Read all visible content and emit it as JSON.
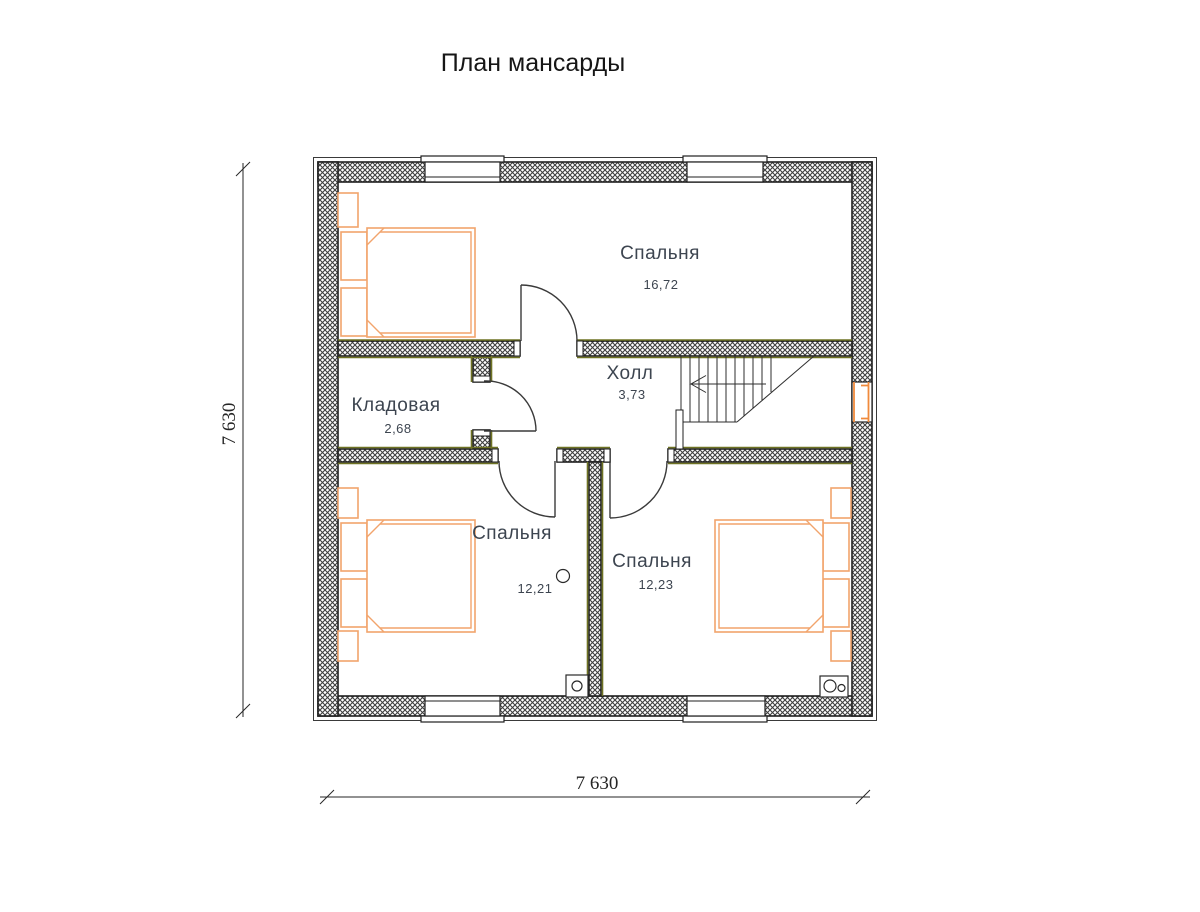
{
  "title": "План мансарды",
  "rooms": {
    "bedroom_top": {
      "name": "Спальня",
      "area": "16,72"
    },
    "hall": {
      "name": "Холл",
      "area": "3,73"
    },
    "storage": {
      "name": "Кладовая",
      "area": "2,68"
    },
    "bedroom_left": {
      "name": "Спальня",
      "area": "12,21"
    },
    "bedroom_right": {
      "name": "Спальня",
      "area": "12,23"
    }
  },
  "dimensions": {
    "overall_width": "7 630",
    "overall_height": "7 630"
  },
  "colors": {
    "wall_hatch": "#3f3f3f",
    "interior_accent": "#6f7324",
    "furniture": "#f2a46c",
    "window_accent": "#f08a3c",
    "label": "#3d4550"
  }
}
